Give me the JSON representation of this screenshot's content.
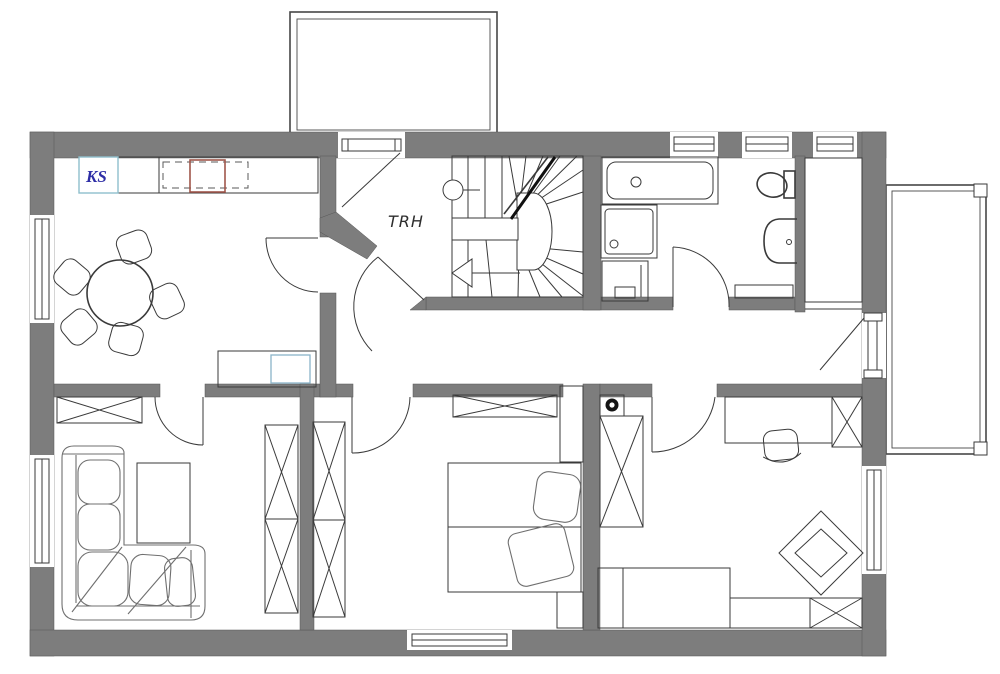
{
  "plan": {
    "title": "upper floor plan",
    "labels": {
      "fridge": "KS",
      "stairwell": "TRH"
    },
    "colors": {
      "wall": "#7d7d7d",
      "line": "#3a3a3a",
      "label_blue": "#2d2da6",
      "cooktop_red": "#a0564b",
      "cabinet_teal": "#8fbfcc",
      "sideboard_blue": "#8ab4c8"
    },
    "symbols": [
      "entrance-porch",
      "right-balcony",
      "winder-staircase",
      "direction-arrow",
      "round-dining-table",
      "dining-chair",
      "kitchen-counter",
      "cooktop",
      "fridge-cabinet",
      "sideboard",
      "wardrobe-x",
      "corner-sofa",
      "coffee-table",
      "double-bed",
      "pillow",
      "duvet",
      "nightstand",
      "desk",
      "office-chair",
      "play-rug",
      "single-bed",
      "bench",
      "vent-shaft",
      "bathtub",
      "shower",
      "washing-machine",
      "toilet",
      "sink",
      "window",
      "door-swing"
    ]
  }
}
